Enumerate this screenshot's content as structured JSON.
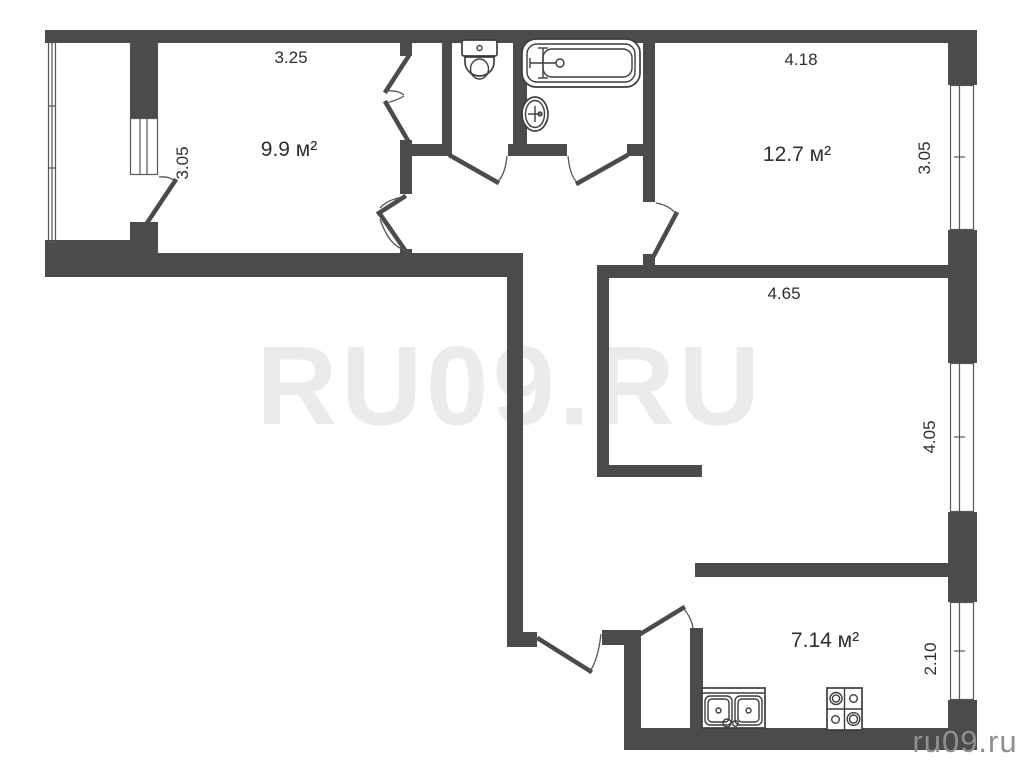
{
  "plan": {
    "watermark_center": "RU09.RU",
    "watermark_corner": "ru09.ru",
    "colors": {
      "wall": "#4b4b4d",
      "background": "#ffffff",
      "watermark": "#ebebeb",
      "corner_watermark": "#8f8f8f"
    },
    "fixtures": [
      "toilet",
      "bathtub",
      "sink",
      "kitchen-sink",
      "stove"
    ],
    "rooms": [
      {
        "id": "room-top-left",
        "area": "9.9 м²",
        "dim_top": "3.25",
        "dim_side": "3.05"
      },
      {
        "id": "room-top-right",
        "area": "12.7 м²",
        "dim_top": "4.18",
        "dim_side": "3.05"
      },
      {
        "id": "room-middle-right",
        "area": "",
        "dim_top": "4.65",
        "dim_side": "4.05"
      },
      {
        "id": "kitchen",
        "area": "7.14 м²",
        "dim_top": "",
        "dim_side": "2.10"
      }
    ]
  }
}
